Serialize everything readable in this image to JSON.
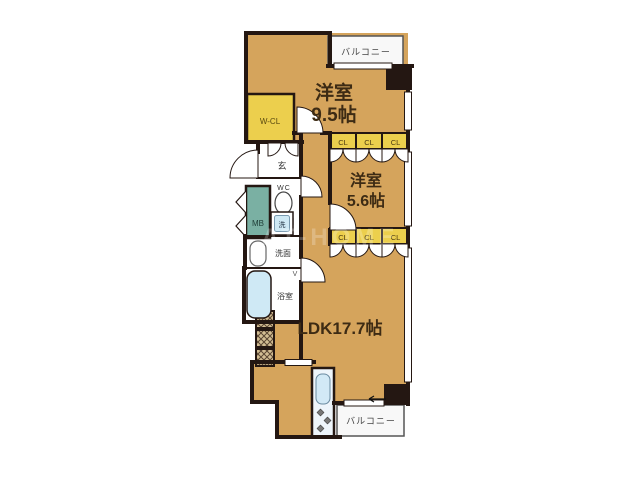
{
  "fp": {
    "bedroom1_line1": "洋室",
    "bedroom1_line2": "9.5帖",
    "bedroom2_line1": "洋室",
    "bedroom2_line2": "5.6帖",
    "ldk": "LDK17.7帖",
    "balcony": "バルコニー",
    "wcl": "W-CL",
    "cl": "CL",
    "entrance": "玄",
    "wc": "WC",
    "mb": "MB",
    "washer": "洗",
    "powder": "洗面",
    "bath": "浴室",
    "vent": "V",
    "watermark": "AT-HOME",
    "colors": {
      "floor": "#d5a45c",
      "closet": "#eccf4d",
      "wall": "#241712",
      "meter_box": "#7ab0a3",
      "water_fixture": "#cfe9f5",
      "balcony_bg": "#f8f8f8",
      "label_text": "#3d2b14"
    }
  }
}
